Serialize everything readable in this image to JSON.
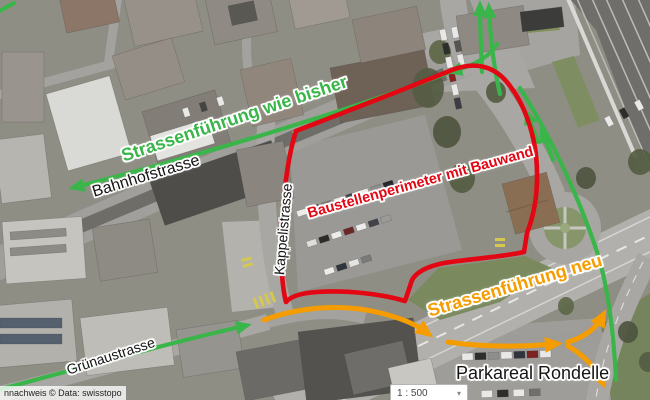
{
  "map": {
    "description": "Aerial photo with construction-site traffic routing annotations",
    "attribution": "nnachweis © Data: swisstopo",
    "scale_control": {
      "value": "1 : 500",
      "chevron_glyph": "▾"
    },
    "annotations": {
      "route_old_label": "Strassenführung wie bisher",
      "route_new_label": "Strassenführung neu",
      "perimeter_label": "Baustellenperimeter mit Bauwand",
      "street_bahnhofstrasse": "Bahnhofstrasse",
      "street_kappelistrasse": "Kappelistrasse",
      "street_gruenaustrasse": "Grünaustrasse",
      "area_parkareal": "Parkareal Rondelle"
    },
    "colors": {
      "route-old-green": "#3ab54a",
      "route-new-orange": "#f59c00",
      "perimeter-red": "#e30613",
      "street-label-black": "#141414"
    }
  }
}
